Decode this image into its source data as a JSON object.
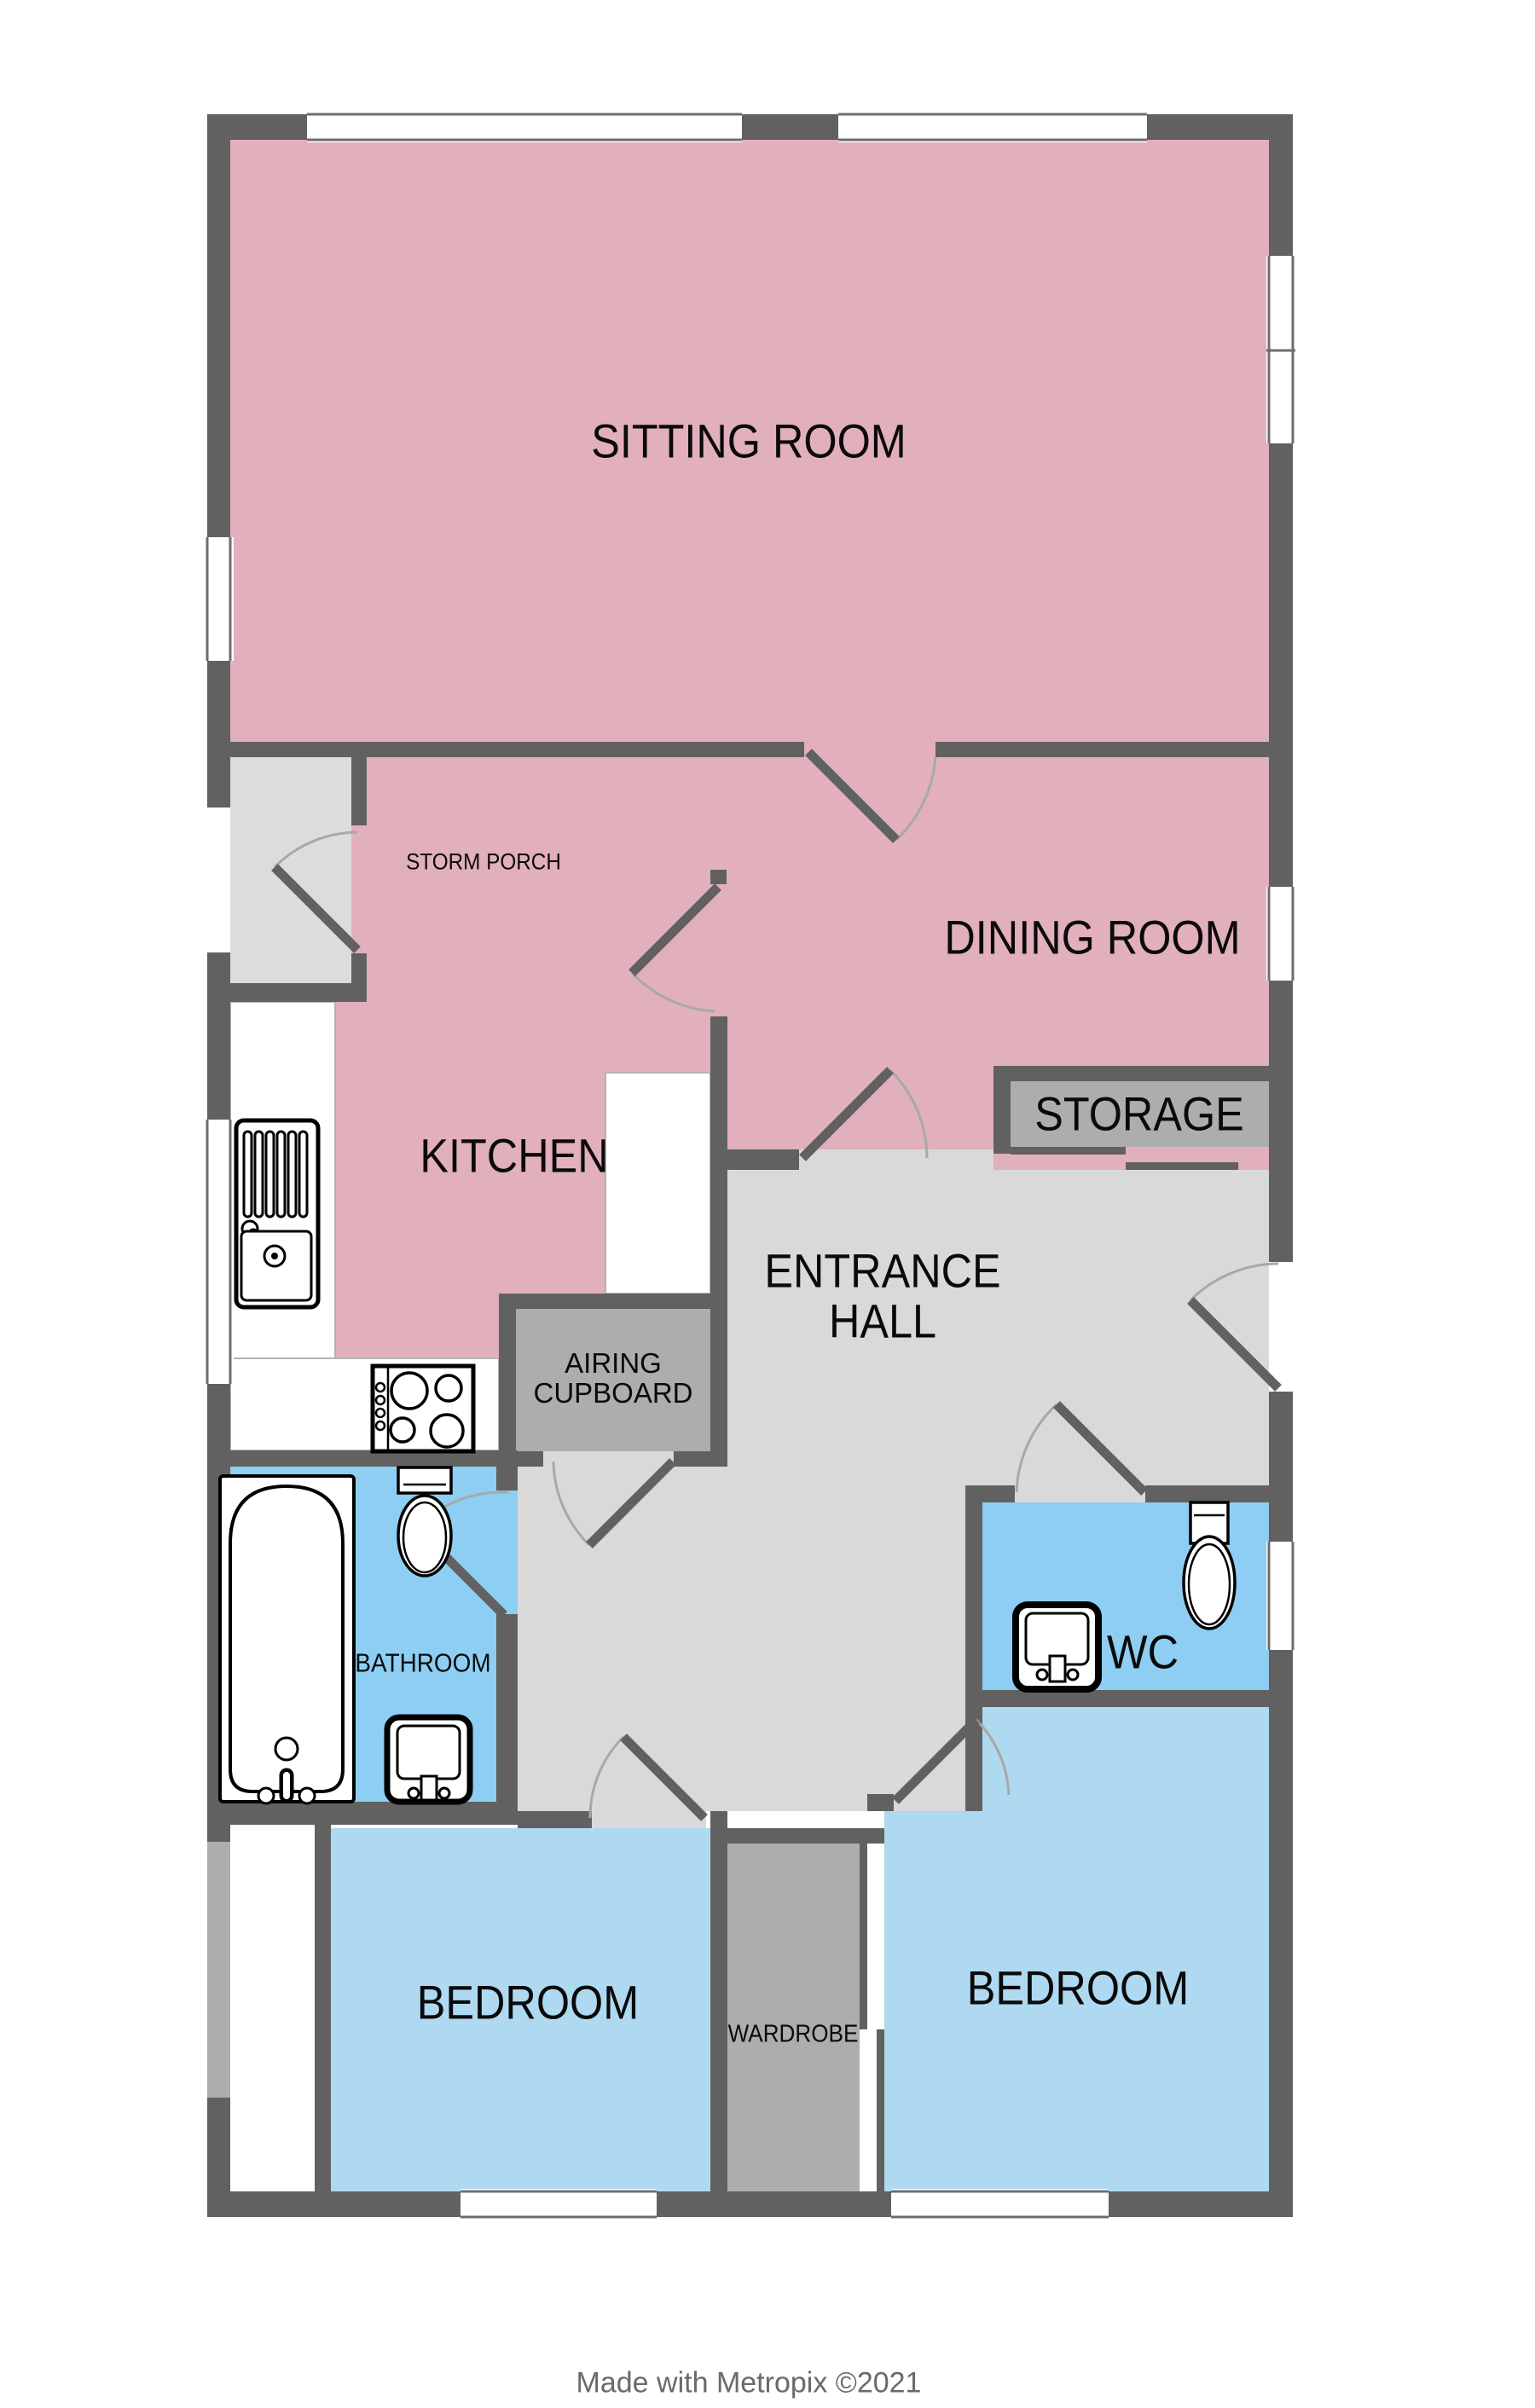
{
  "title": "Bungalow floor plan",
  "rooms": {
    "sitting_room": {
      "label": "SITTING ROOM"
    },
    "storm_porch": {
      "label": "STORM PORCH"
    },
    "dining_room": {
      "label": "DINING ROOM"
    },
    "kitchen": {
      "label": "KITCHEN"
    },
    "storage": {
      "label": "STORAGE"
    },
    "entrance_hall": {
      "line1": "ENTRANCE",
      "line2": "HALL"
    },
    "airing_cupboard": {
      "line1": "AIRING",
      "line2": "CUPBOARD"
    },
    "bathroom": {
      "label": "BATHROOM"
    },
    "wc": {
      "label": "WC"
    },
    "bedroom_left": {
      "label": "BEDROOM"
    },
    "wardrobe": {
      "label": "WARDROBE"
    },
    "bedroom_right": {
      "label": "BEDROOM"
    }
  },
  "fixtures": {
    "kitchen_sink": "kitchen-sink-unit",
    "hob": "cooker-hob",
    "bathtub": "bathtub",
    "bathroom_toilet": "toilet",
    "bathroom_basin": "washbasin",
    "wc_toilet": "toilet",
    "wc_basin": "washbasin"
  },
  "credit": "Made with Metropix ©2021",
  "colors": {
    "wall": "#616161",
    "room_pink": "#E2AFBC",
    "wet_room_blue": "#8ECEF3",
    "bedroom_blue": "#AED9F1",
    "hall_gray": "#D9D9D9",
    "cupboard_gray": "#ADADAD",
    "porch_gray": "#DCDCDC",
    "arc": "#A8A8A8",
    "text": "#0A0A0A",
    "credit": "#6A6A6A"
  }
}
